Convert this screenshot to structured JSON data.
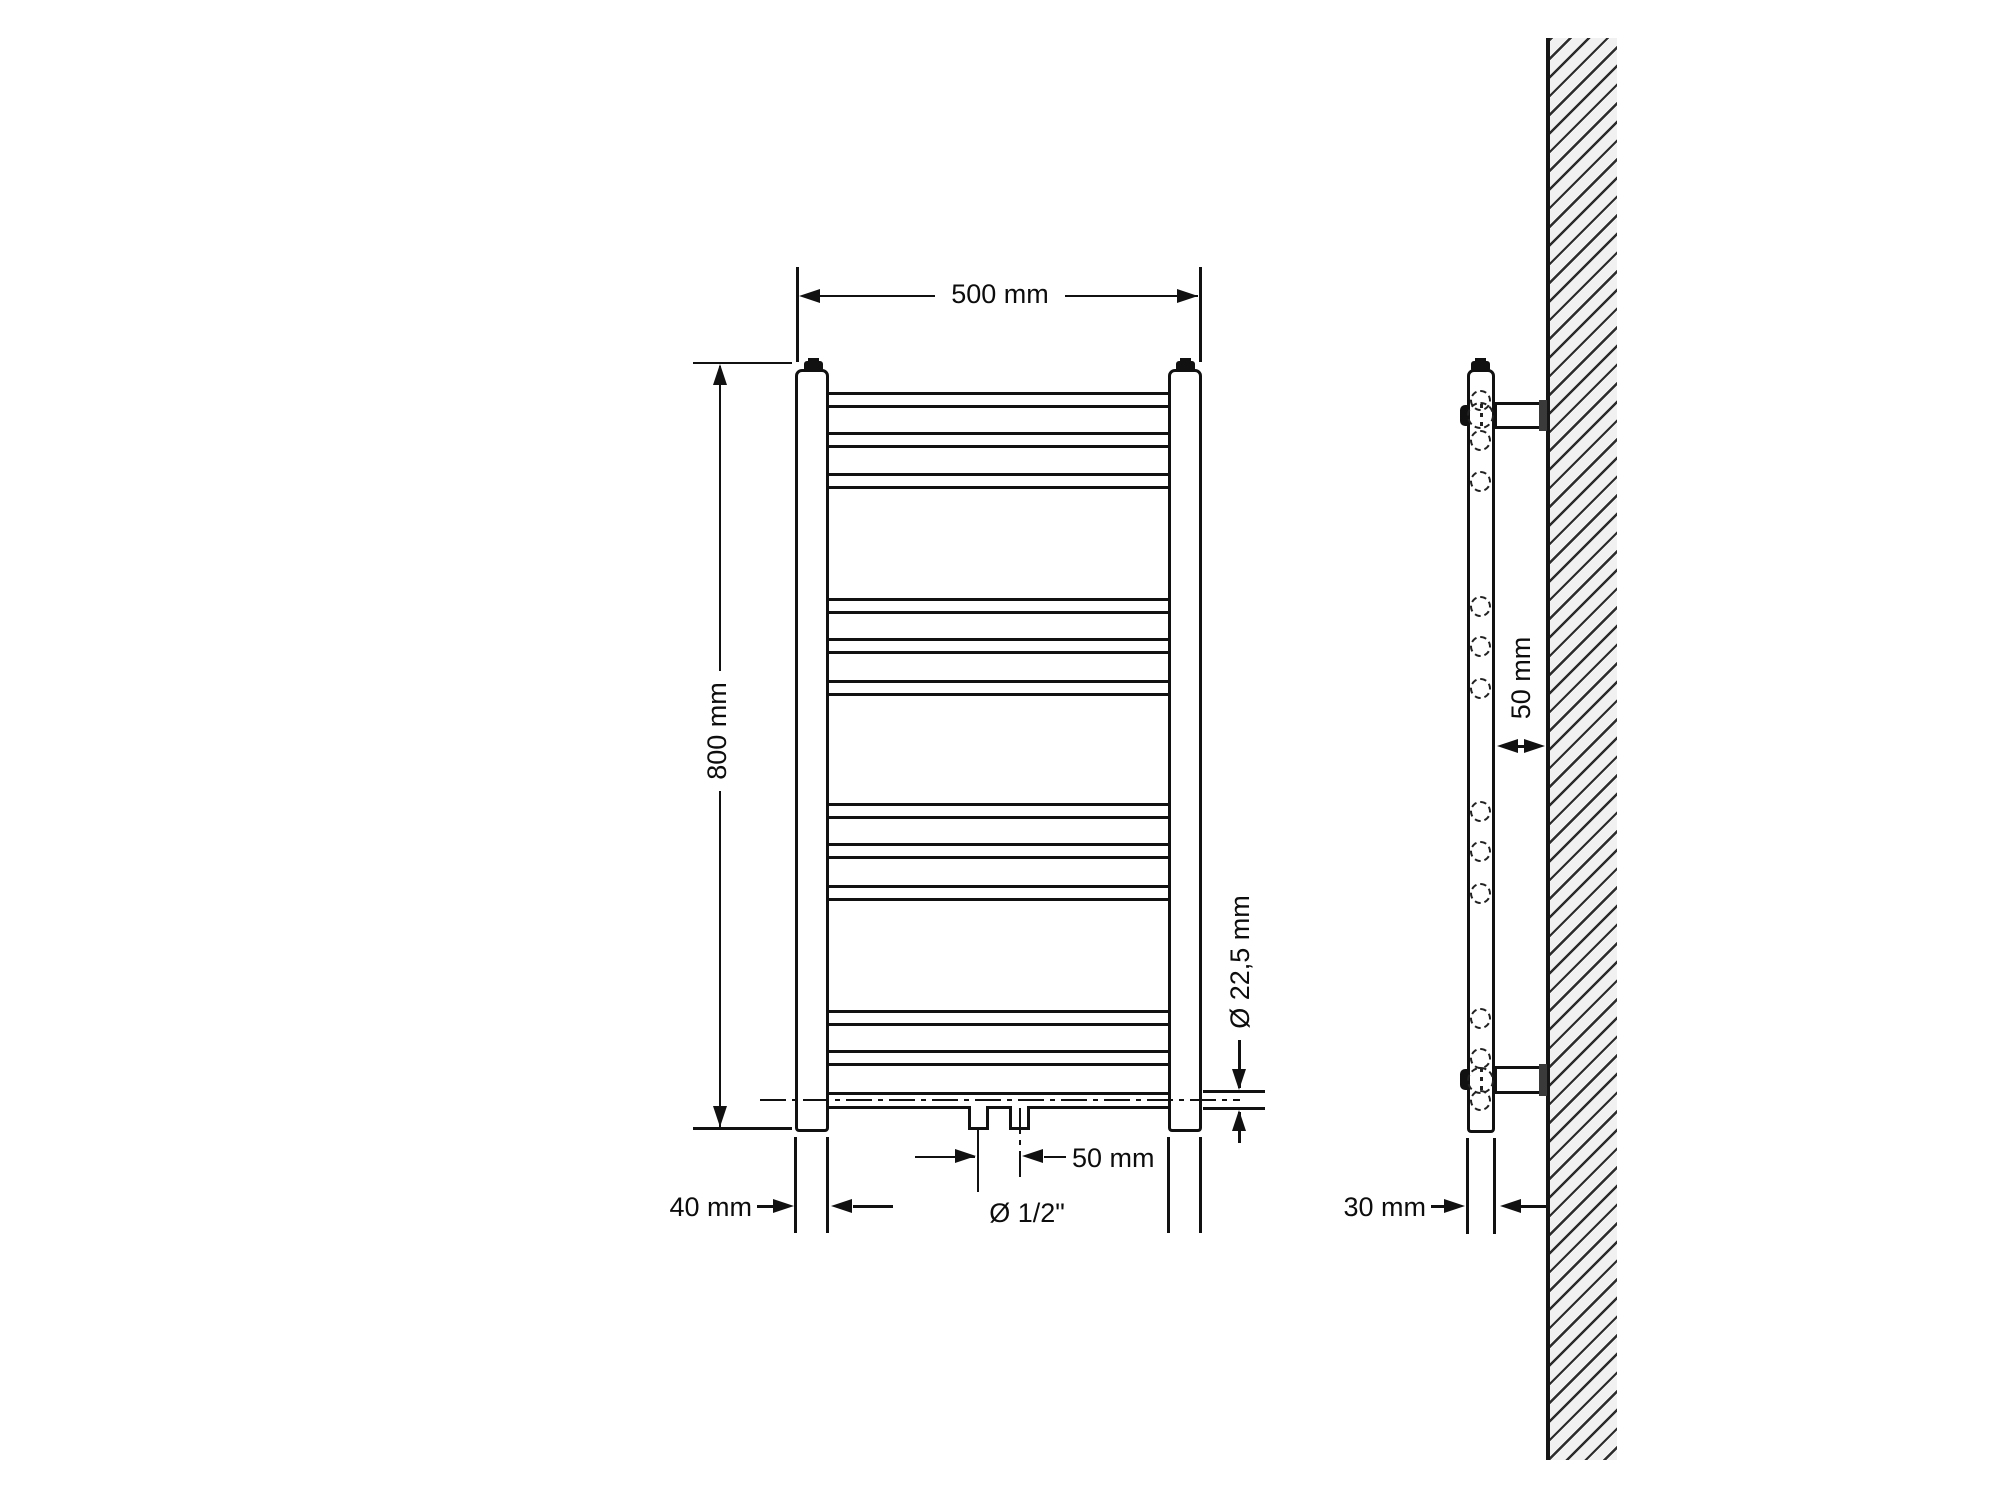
{
  "drawing": {
    "line_color": "#111111",
    "background": "#ffffff",
    "wall_fill": "#f1f1f1",
    "wall_hatch_color": "#2c2c2c"
  },
  "front_view": {
    "width_label": "500 mm",
    "height_label": "800 mm",
    "tube_diameter_label": "Ø 22,5 mm",
    "connection_spacing_label": "50 mm",
    "connection_thread_label": "Ø 1/2\"",
    "column_width_label": "40 mm",
    "rung_groups": [
      3,
      3,
      3,
      2
    ],
    "rung_count": 11
  },
  "side_view": {
    "wall_distance_label": "50 mm",
    "pipe_width_label": "30 mm",
    "bracket_count": 2,
    "hidden_tube_circles": 12
  }
}
